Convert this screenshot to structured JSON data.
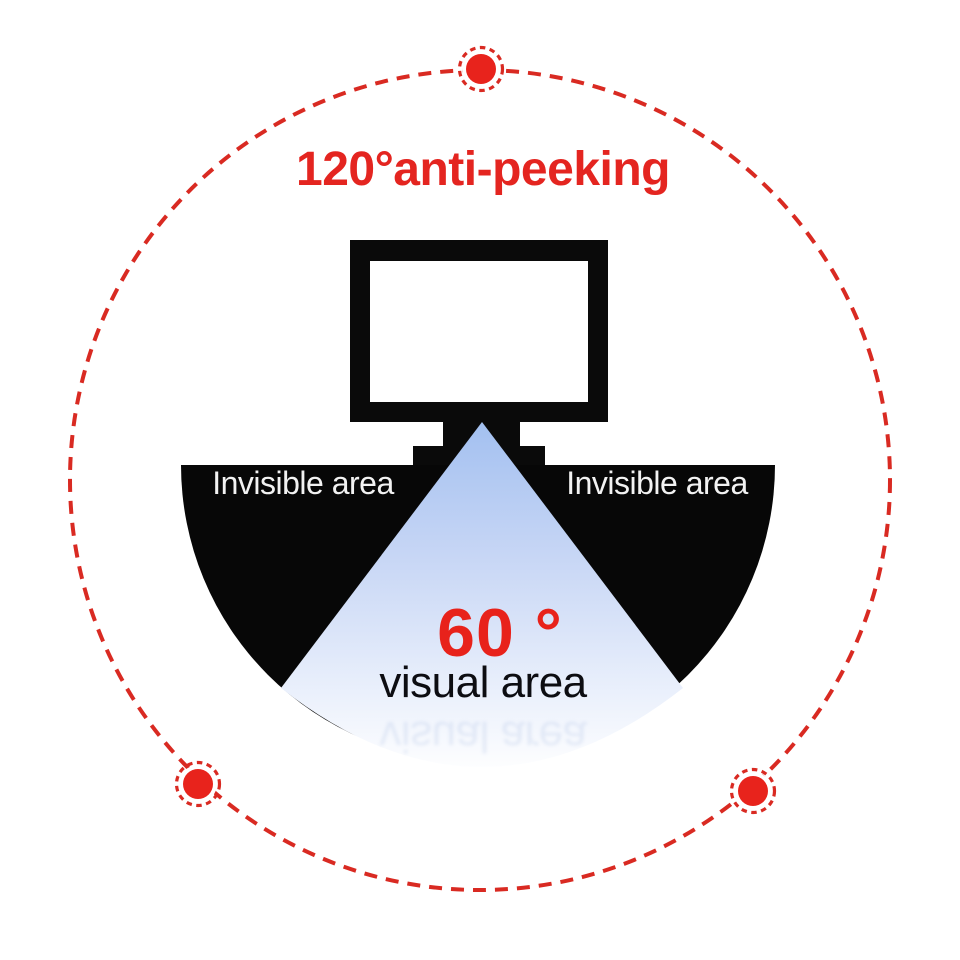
{
  "title": {
    "text": "120°anti-peeking",
    "color": "#e42520"
  },
  "labels": {
    "invisible_left": "Invisible area",
    "invisible_right": "Invisible area",
    "visual_angle": "60 °",
    "visual_area": "visual area",
    "visual_area_reflection": "visual area"
  },
  "angles": {
    "anti_peeking_deg": "120°",
    "visual_deg": "60°"
  },
  "colors": {
    "accent_red": "#e42520",
    "dashed_circle_red": "#d92a22",
    "fan_black": "#070707",
    "cone_blue_top": "#a3c0f0",
    "cone_blue_bottom": "#ffffff",
    "screen_white": "#ffffff"
  },
  "icons": {
    "monitor": "monitor-icon",
    "viewer_dots": "viewer-dot-icon"
  }
}
